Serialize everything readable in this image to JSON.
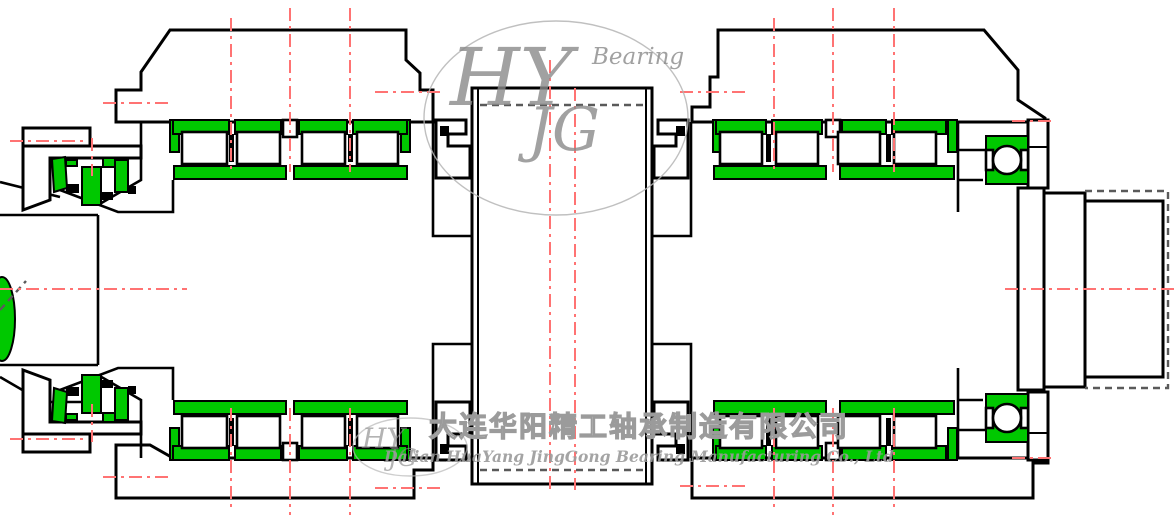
{
  "drawing": {
    "watermark": {
      "brand_top": "HY",
      "brand_word": "Bearing",
      "brand_sub": "JG",
      "brand_small_top": "HY",
      "brand_small_sub": "JG"
    },
    "company": {
      "name_cn": "大连华阳精工轴承制造有限公司",
      "name_en": "Dalian HuaYang JingGong Bearing Manufacturing Co., Ltd"
    }
  },
  "colors": {
    "highlight": "#00c800",
    "centerline": "#ff7373",
    "outline": "#000000",
    "hidden": "#5a5a5a",
    "watermark": "#8a8a8a"
  }
}
